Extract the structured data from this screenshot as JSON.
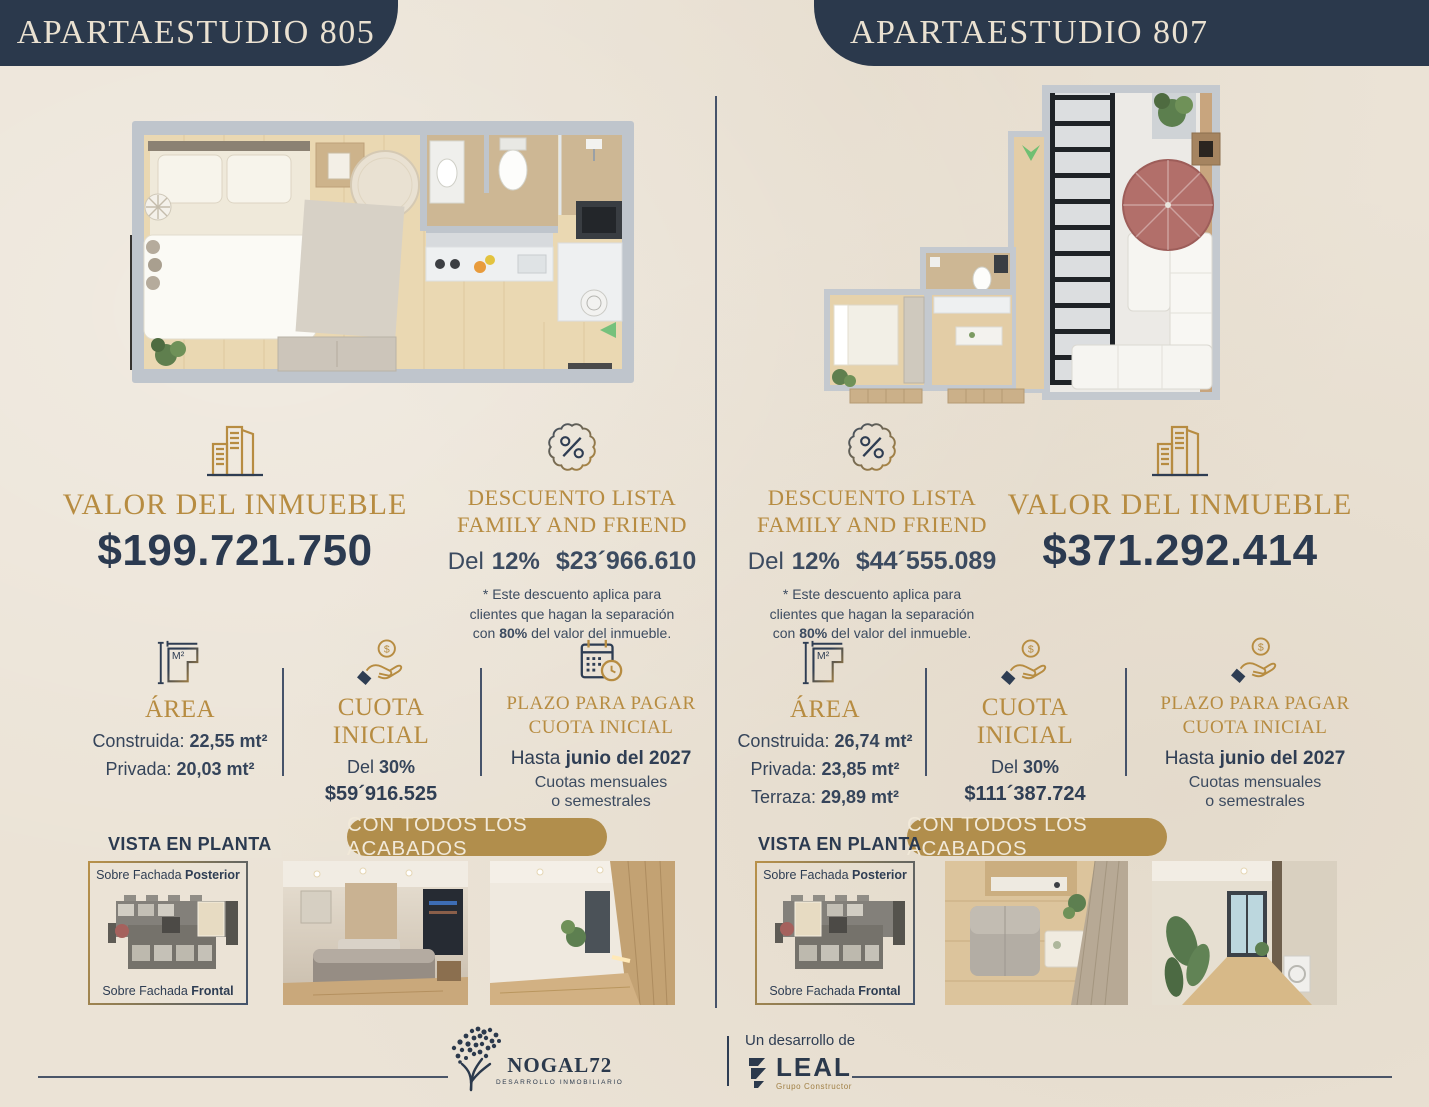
{
  "theme": {
    "background": "#ebe3d6",
    "navy": "#2b394c",
    "gold": "#b78c41",
    "pill_gold": "#b18e4c",
    "body_text": "#324155"
  },
  "left": {
    "header": "APARTAESTUDIO 805",
    "valor": {
      "title": "VALOR DEL INMUEBLE",
      "price": "$199.721.750"
    },
    "discount": {
      "title_line1": "DESCUENTO LISTA",
      "title_line2": "FAMILY AND FRIEND",
      "del": "Del",
      "percent": "12%",
      "amount": "$23´966.610",
      "note_line1": "* Este descuento aplica para",
      "note_line2": "clientes que hagan la separación",
      "note3_prefix": "con",
      "note3_bold": "80%",
      "note3_suffix": "del valor del inmueble."
    },
    "area": {
      "title": "ÁREA",
      "rows": [
        {
          "label": "Construida:",
          "value": "22,55 mt²"
        },
        {
          "label": "Privada:",
          "value": "20,03 mt²"
        }
      ]
    },
    "cuota": {
      "title": "CUOTA INICIAL",
      "del": "Del",
      "percent": "30%",
      "amount": "$59´916.525"
    },
    "plazo": {
      "title_line1": "PLAZO PARA PAGAR",
      "title_line2": "CUOTA INICIAL",
      "hasta": "Hasta",
      "date": "junio del 2027",
      "sub_line1": "Cuotas mensuales",
      "sub_line2": "o semestrales"
    },
    "badge": "CON TODOS LOS ACABADOS",
    "vista": {
      "title": "VISTA EN PLANTA",
      "top_prefix": "Sobre Fachada",
      "top_bold": "Posterior",
      "bottom_prefix": "Sobre Fachada",
      "bottom_bold": "Frontal"
    }
  },
  "right": {
    "header": "APARTAESTUDIO 807",
    "valor": {
      "title": "VALOR DEL INMUEBLE",
      "price": "$371.292.414"
    },
    "discount": {
      "title_line1": "DESCUENTO LISTA",
      "title_line2": "FAMILY AND FRIEND",
      "del": "Del",
      "percent": "12%",
      "amount": "$44´555.089",
      "note_line1": "* Este descuento aplica para",
      "note_line2": "clientes que hagan la separación",
      "note3_prefix": "con",
      "note3_bold": "80%",
      "note3_suffix": "del valor del inmueble."
    },
    "area": {
      "title": "ÁREA",
      "rows": [
        {
          "label": "Construida:",
          "value": "26,74 mt²"
        },
        {
          "label": "Privada:",
          "value": "23,85 mt²"
        },
        {
          "label": "Terraza:",
          "value": "29,89 mt²"
        }
      ]
    },
    "cuota": {
      "title": "CUOTA INICIAL",
      "del": "Del",
      "percent": "30%",
      "amount": "$111´387.724"
    },
    "plazo": {
      "title_line1": "PLAZO PARA PAGAR",
      "title_line2": "CUOTA INICIAL",
      "hasta": "Hasta",
      "date": "junio del 2027",
      "sub_line1": "Cuotas mensuales",
      "sub_line2": "o semestrales"
    },
    "badge": "CON TODOS LOS ACABADOS",
    "vista": {
      "title": "VISTA EN PLANTA",
      "top_prefix": "Sobre Fachada",
      "top_bold": "Posterior",
      "bottom_prefix": "Sobre Fachada",
      "bottom_bold": "Frontal"
    }
  },
  "footer": {
    "left_brand": {
      "name": "NOGAL72",
      "tagline": "DESARROLLO INMOBILIARIO"
    },
    "middle": "Un desarrollo de",
    "right_brand": {
      "name": "LEAL",
      "tagline": "Grupo Constructor"
    }
  }
}
